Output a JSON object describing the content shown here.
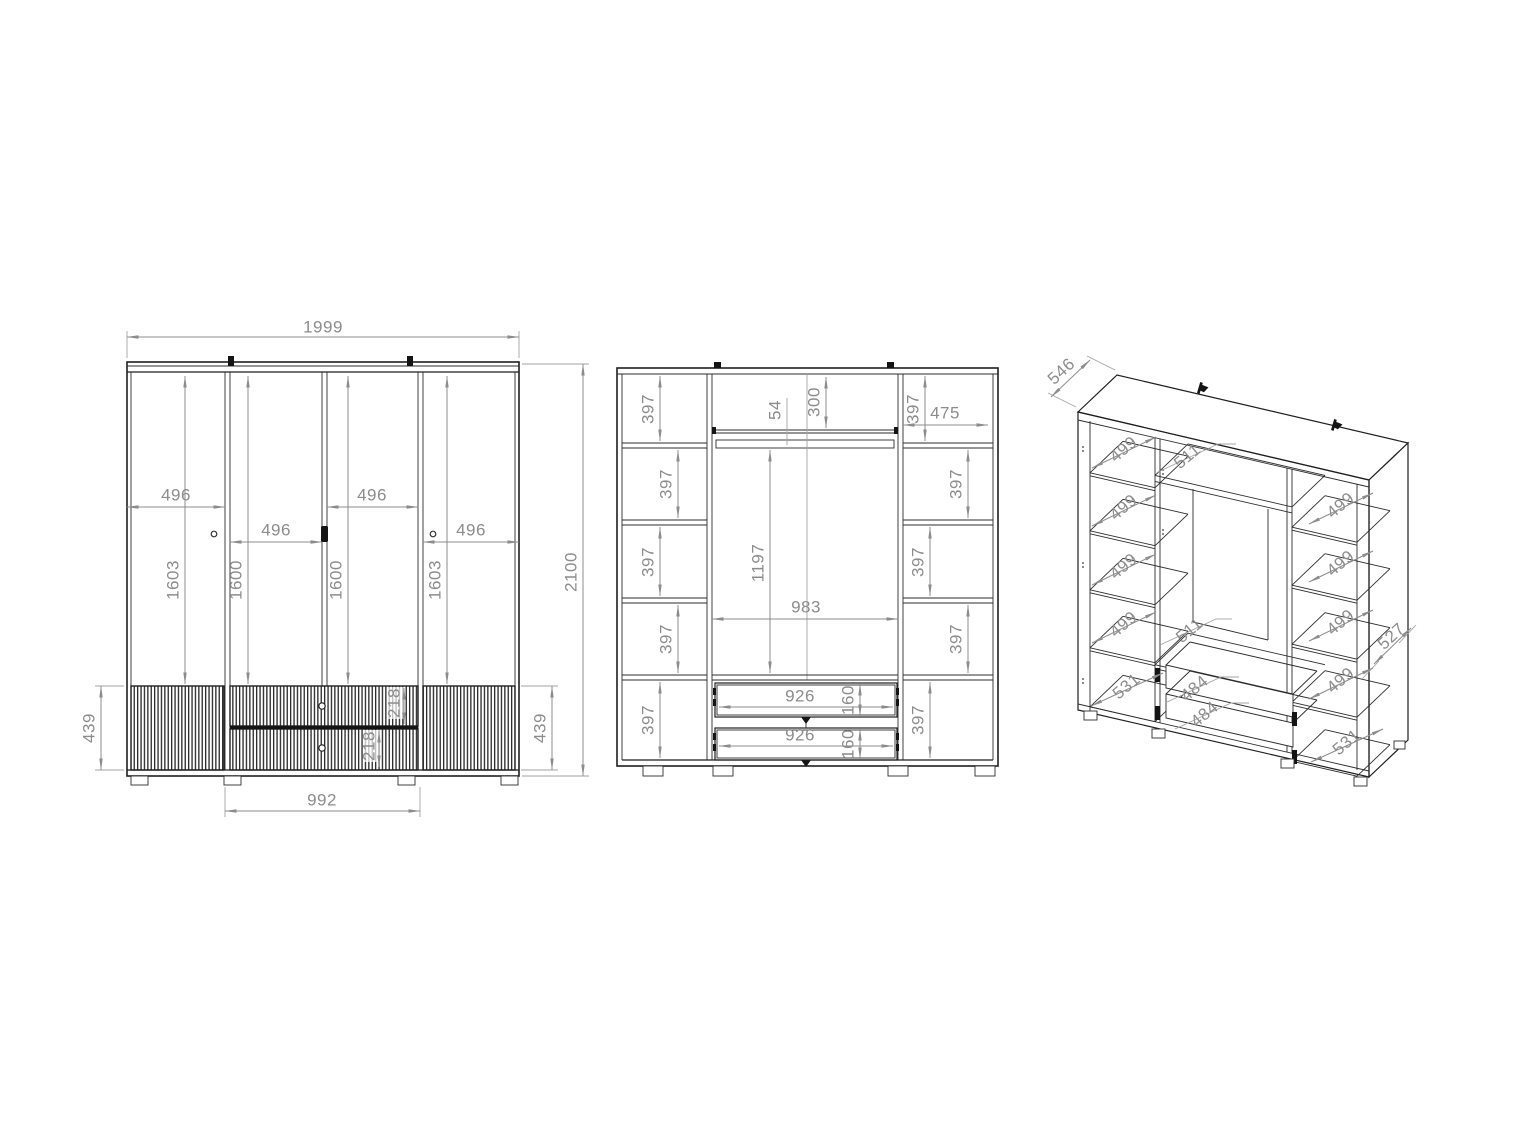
{
  "colors": {
    "line": "#1f1f1f",
    "dimension": "#8c8c8c",
    "background": "#ffffff"
  },
  "front_view": {
    "overall_width": "1999",
    "overall_height": "2100",
    "door_widths": [
      "496",
      "496",
      "496",
      "496"
    ],
    "door_heights": [
      "1603",
      "1600",
      "1600",
      "1603"
    ],
    "base_heights": [
      "439",
      "439"
    ],
    "drawer_unit_width": "992",
    "drawer_front_heights": [
      "218",
      "218"
    ]
  },
  "internal_view": {
    "left_cells": [
      "397",
      "397",
      "397",
      "397",
      "397"
    ],
    "right_cells": [
      "397",
      "397",
      "397",
      "397",
      "397"
    ],
    "right_top_width": "475",
    "rail_offset": "54",
    "top_section_height": "300",
    "hanging_height": "1197",
    "center_width": "983",
    "drawers": [
      {
        "width": "926",
        "height": "160"
      },
      {
        "width": "926",
        "height": "160"
      }
    ]
  },
  "perspective_view": {
    "top_depth": "546",
    "right_side_depth": "527",
    "top_shelf_depth": "511",
    "drawer_shelf_depth": "511",
    "left_shelf_depths": [
      "499",
      "499",
      "499",
      "499"
    ],
    "left_bottom_depth": "531",
    "right_shelf_depths": [
      "499",
      "499",
      "499",
      "499"
    ],
    "right_bottom_depth": "531",
    "drawer_depths": [
      "484",
      "484"
    ]
  }
}
